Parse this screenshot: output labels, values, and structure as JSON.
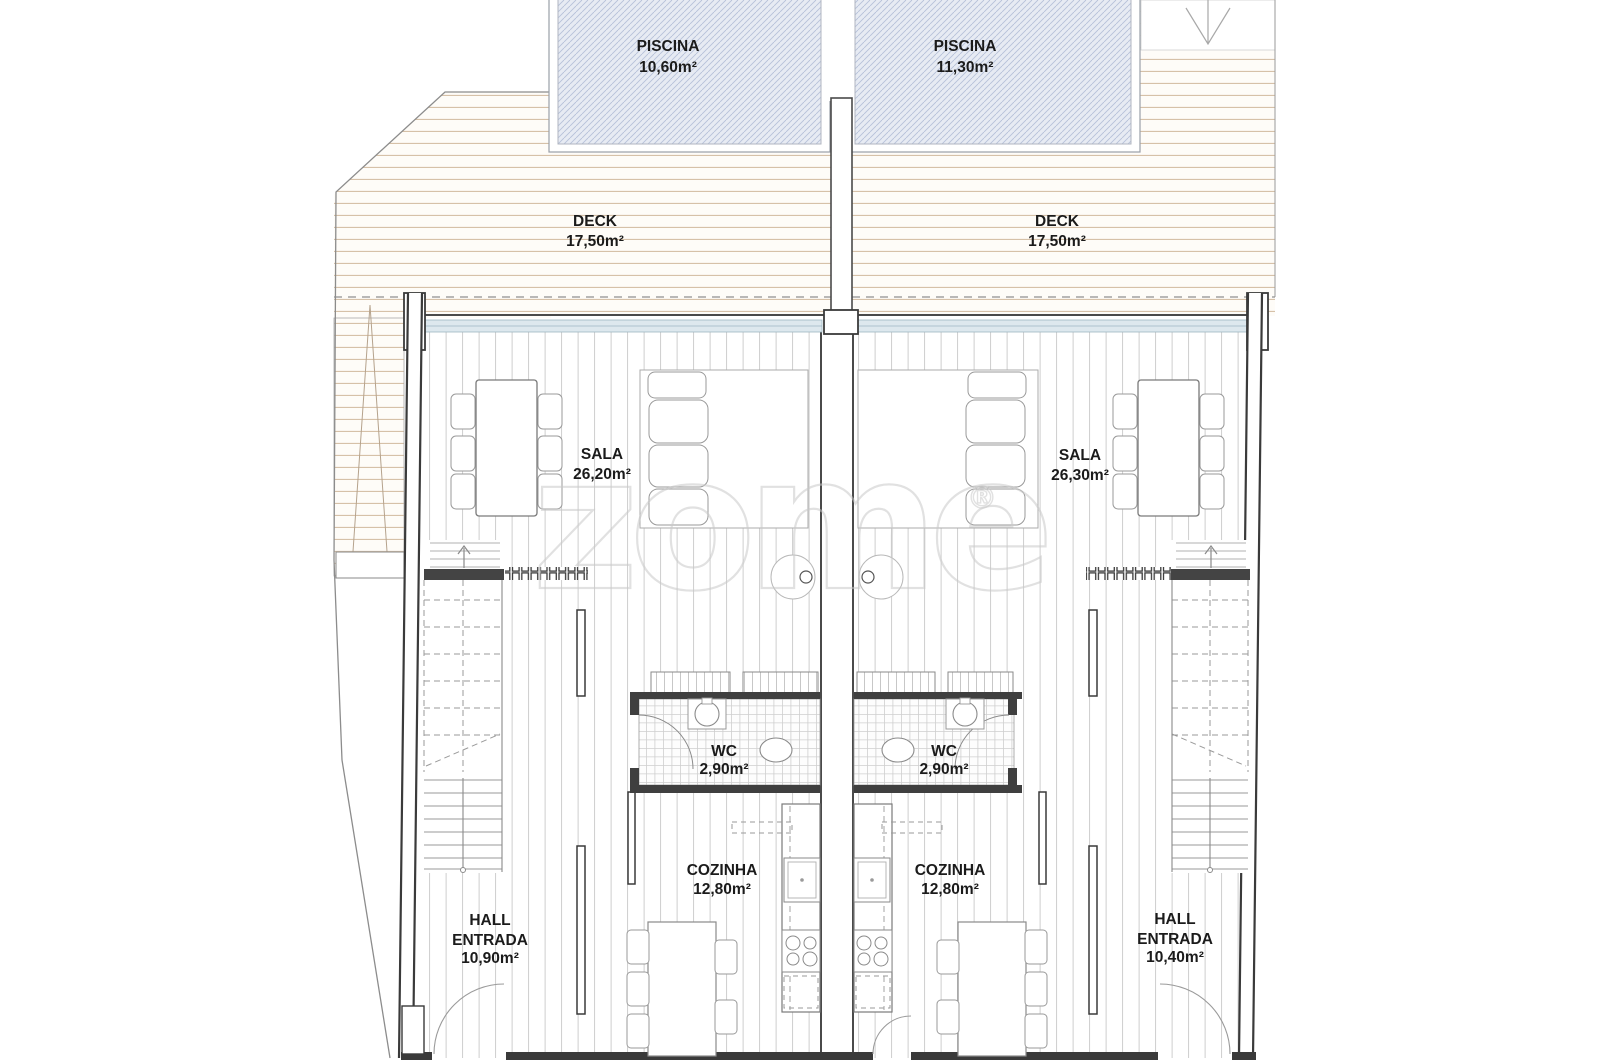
{
  "plan": {
    "watermark": {
      "text": "zome",
      "reg": "®"
    },
    "units": {
      "left": {
        "piscina": {
          "label": "PISCINA",
          "area": "10,60m²"
        },
        "deck": {
          "label": "DECK",
          "area": "17,50m²"
        },
        "sala": {
          "label": "SALA",
          "area": "26,20m²"
        },
        "wc": {
          "label": "WC",
          "area": "2,90m²"
        },
        "cozinha": {
          "label": "COZINHA",
          "area": "12,80m²"
        },
        "hall": {
          "line1": "HALL",
          "line2": "ENTRADA",
          "area": "10,90m²"
        }
      },
      "right": {
        "piscina": {
          "label": "PISCINA",
          "area": "11,30m²"
        },
        "deck": {
          "label": "DECK",
          "area": "17,50m²"
        },
        "sala": {
          "label": "SALA",
          "area": "26,30m²"
        },
        "wc": {
          "label": "WC",
          "area": "2,90m²"
        },
        "cozinha": {
          "label": "COZINHA",
          "area": "12,80m²"
        },
        "hall": {
          "line1": "HALL",
          "line2": "ENTRADA",
          "area": "10,40m²"
        }
      }
    },
    "colors": {
      "wall": "#3a3a3a",
      "pool_fill": "#e7ebf3",
      "pool_hatch": "#b6c1d8",
      "deck_line": "#d6c1a8",
      "floor_line": "#c9c9c9",
      "glazing": "#dde8ee",
      "text": "#1b1b1b",
      "watermark": "#c9c9c9"
    }
  }
}
